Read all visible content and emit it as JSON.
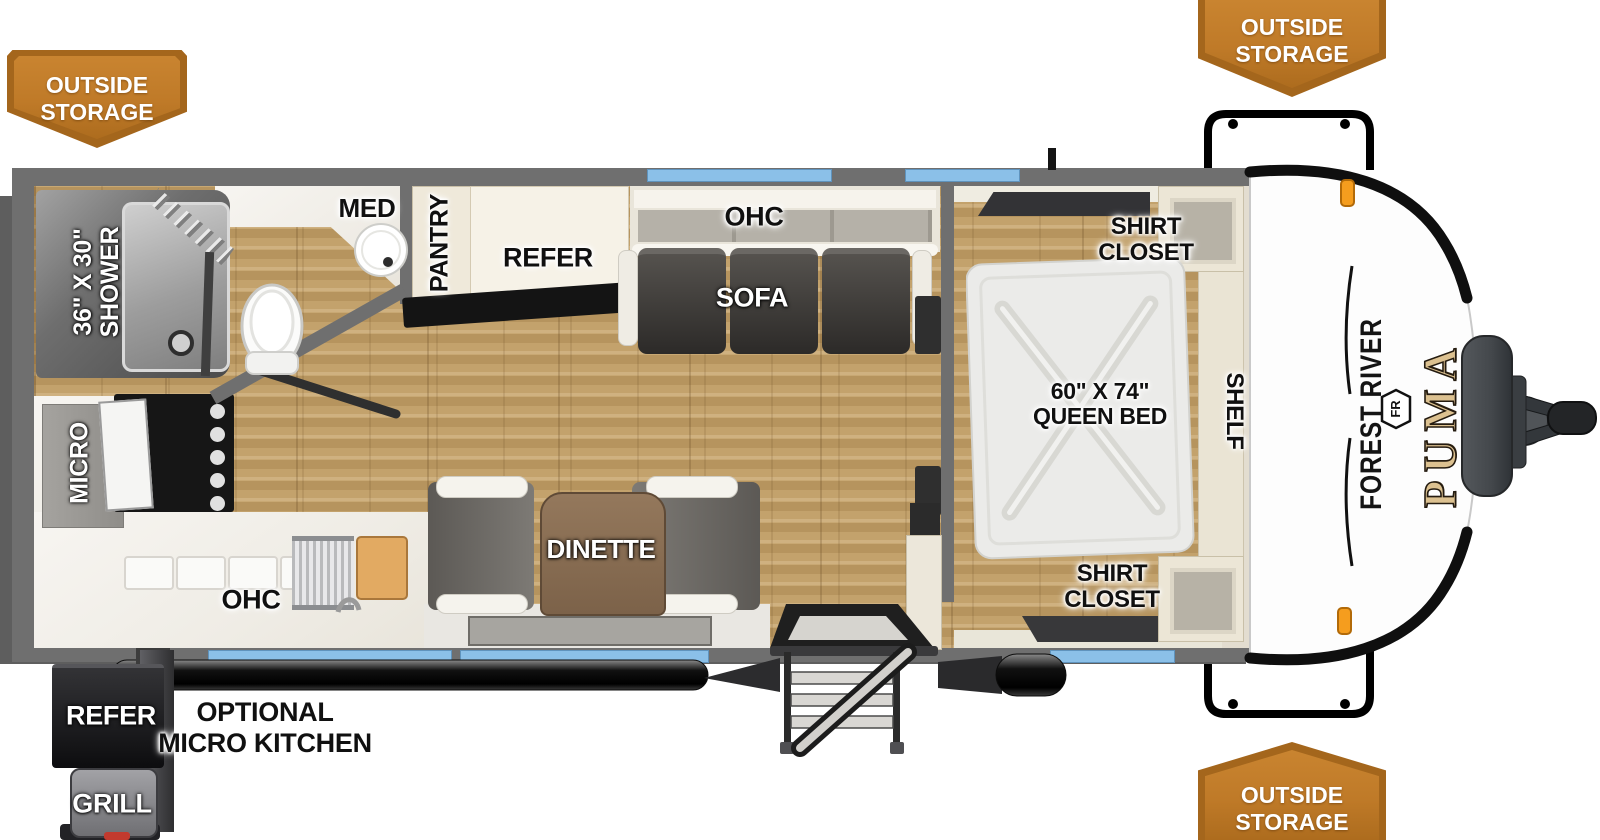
{
  "banners": {
    "line1": "OUTSIDE",
    "line2": "STORAGE"
  },
  "labels": {
    "shower_line1": "36\" X 30\"",
    "shower_line2": "SHOWER",
    "med": "MED",
    "pantry": "PANTRY",
    "refer": "REFER",
    "ohc_top": "OHC",
    "sofa": "SOFA",
    "shirt_line1": "SHIRT",
    "shirt_line2": "CLOSET",
    "bed_line1": "60\" X 74\"",
    "bed_line2": "QUEEN BED",
    "shelf": "SHELF",
    "micro": "MICRO",
    "ohc_bottom": "OHC",
    "dinette": "DINETTE",
    "outside_refer": "REFER",
    "grill": "GRILL",
    "optional_line1": "OPTIONAL",
    "optional_line2": "MICRO KITCHEN"
  },
  "branding": {
    "maker": "FOREST RIVER",
    "model": "PUMA",
    "monogram": "FR"
  },
  "colors": {
    "banner_orange": "#bf7a28",
    "banner_edge": "#a4661c",
    "window_blue": "#8bc0e8",
    "wall_gray": "#6f6f6f",
    "puma_gold": "#dcc190",
    "floor_wood": "#c2a169"
  }
}
